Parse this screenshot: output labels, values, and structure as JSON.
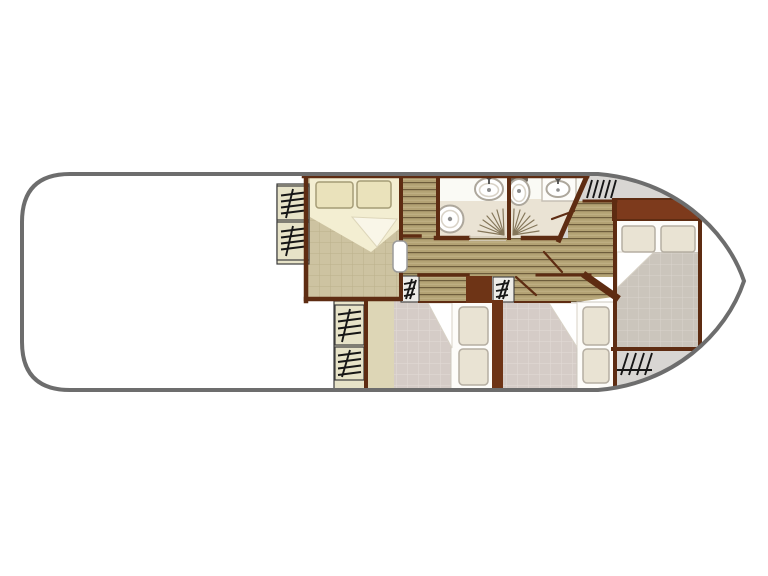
{
  "title": "houseboat-floor-plan",
  "colors": {
    "page_bg": "#ffffff",
    "hull_stroke": "#6d6d6d",
    "hull_fill": "#ffffff",
    "deck_gray": "#d8d6d3",
    "wall": "#5e2c12",
    "wall_block": "#6e3416",
    "band": "#7d3a1c",
    "wood_base": "#b3a274",
    "wood_line": "#6e5d3c",
    "wood_hi": "#c2b387",
    "tan_tile": "#cdc3a1",
    "tan_grid": "#bbb08c",
    "strip": "#ddd6b6",
    "pink_tile": "#d5ccc7",
    "pink_grid": "#e2dbd7",
    "gray_tile": "#cbc5bc",
    "gray_grid": "#dad4cd",
    "bed_cream": "#f3eed2",
    "bed_fold": "#f9f6e8",
    "pillow_cream": "#eae2bb",
    "pillow_cream_stroke": "#a59c76",
    "bed_white": "#fdfcf9",
    "pillow_white": "#e9e3d3",
    "pillow_white_stroke": "#b5aea2",
    "bath_floor": "#eae3d4",
    "bath_upper": "#fafaf5",
    "fixture_stroke": "#ada79c",
    "fixture_detail": "#8d8d8d",
    "tap": "#4a4a4a",
    "spray": "#85775a",
    "steps_bg": "#e7e3c8",
    "steps_small_bg": "#edece8",
    "steps_stroke": "#161616",
    "steps_border": "#3c3c3c",
    "threshold": "#cfc5b0",
    "door_leaf": "#ffffff",
    "door_leaf_stroke": "#9b9b9b"
  },
  "rooms": [
    {
      "id": "aft-deck",
      "label": "open aft deck"
    },
    {
      "id": "port-cabin",
      "label": "double-bed cabin"
    },
    {
      "id": "closet",
      "label": "closet"
    },
    {
      "id": "corridor",
      "label": "central corridor"
    },
    {
      "id": "bathroom-1",
      "label": "bathroom with shower, sink and toilet"
    },
    {
      "id": "bathroom-2",
      "label": "bathroom with shower, sink and toilet"
    },
    {
      "id": "lower-cabin-left",
      "label": "single-bed cabin"
    },
    {
      "id": "lower-cabin-right",
      "label": "single-bed cabin"
    },
    {
      "id": "fore-cabin",
      "label": "bow double-bed cabin"
    },
    {
      "id": "fore-deck",
      "label": "bow deck"
    }
  ],
  "icons": [
    "steps-icon",
    "sink-icon",
    "toilet-icon",
    "shower-spray-icon",
    "double-bed-icon",
    "single-bed-icon",
    "pillow-icon",
    "door-leaf-icon"
  ],
  "beds": {
    "double": 2,
    "single": 2
  },
  "stair_flights": 8
}
